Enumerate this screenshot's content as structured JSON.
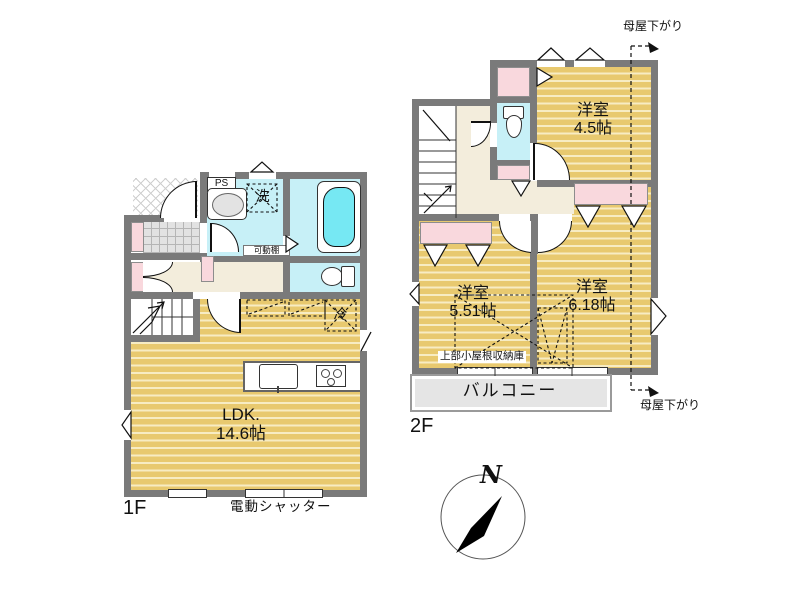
{
  "floor1": {
    "label": "1F",
    "rooms": [
      {
        "name": "LDK.",
        "size": "14.6帖"
      }
    ],
    "fixtures": {
      "ps": "PS",
      "washer": "洗",
      "shelf": "可動棚",
      "fridge": "冷"
    },
    "shutter": "電動シャッター"
  },
  "floor2": {
    "label": "2F",
    "rooms": [
      {
        "name": "洋室",
        "size": "4.5帖"
      },
      {
        "name": "洋室",
        "size": "5.51帖"
      },
      {
        "name": "洋室",
        "size": "6.18帖"
      }
    ],
    "balcony": "バルコニー",
    "attic_storage": "上部小屋根収納庫",
    "roof_note_top": "母屋下がり",
    "roof_note_bottom": "母屋下がり"
  },
  "compass": {
    "north": "N"
  },
  "colors": {
    "wood_floor": "#e8c96f",
    "water_blue": "#c7f0f7",
    "bathtub": "#76e8f3",
    "closet_pink": "#f9d8dd",
    "hall_beige": "#f3eddc",
    "wall_gray": "#7a7a7a",
    "balcony_gray": "#e5e5e5"
  }
}
